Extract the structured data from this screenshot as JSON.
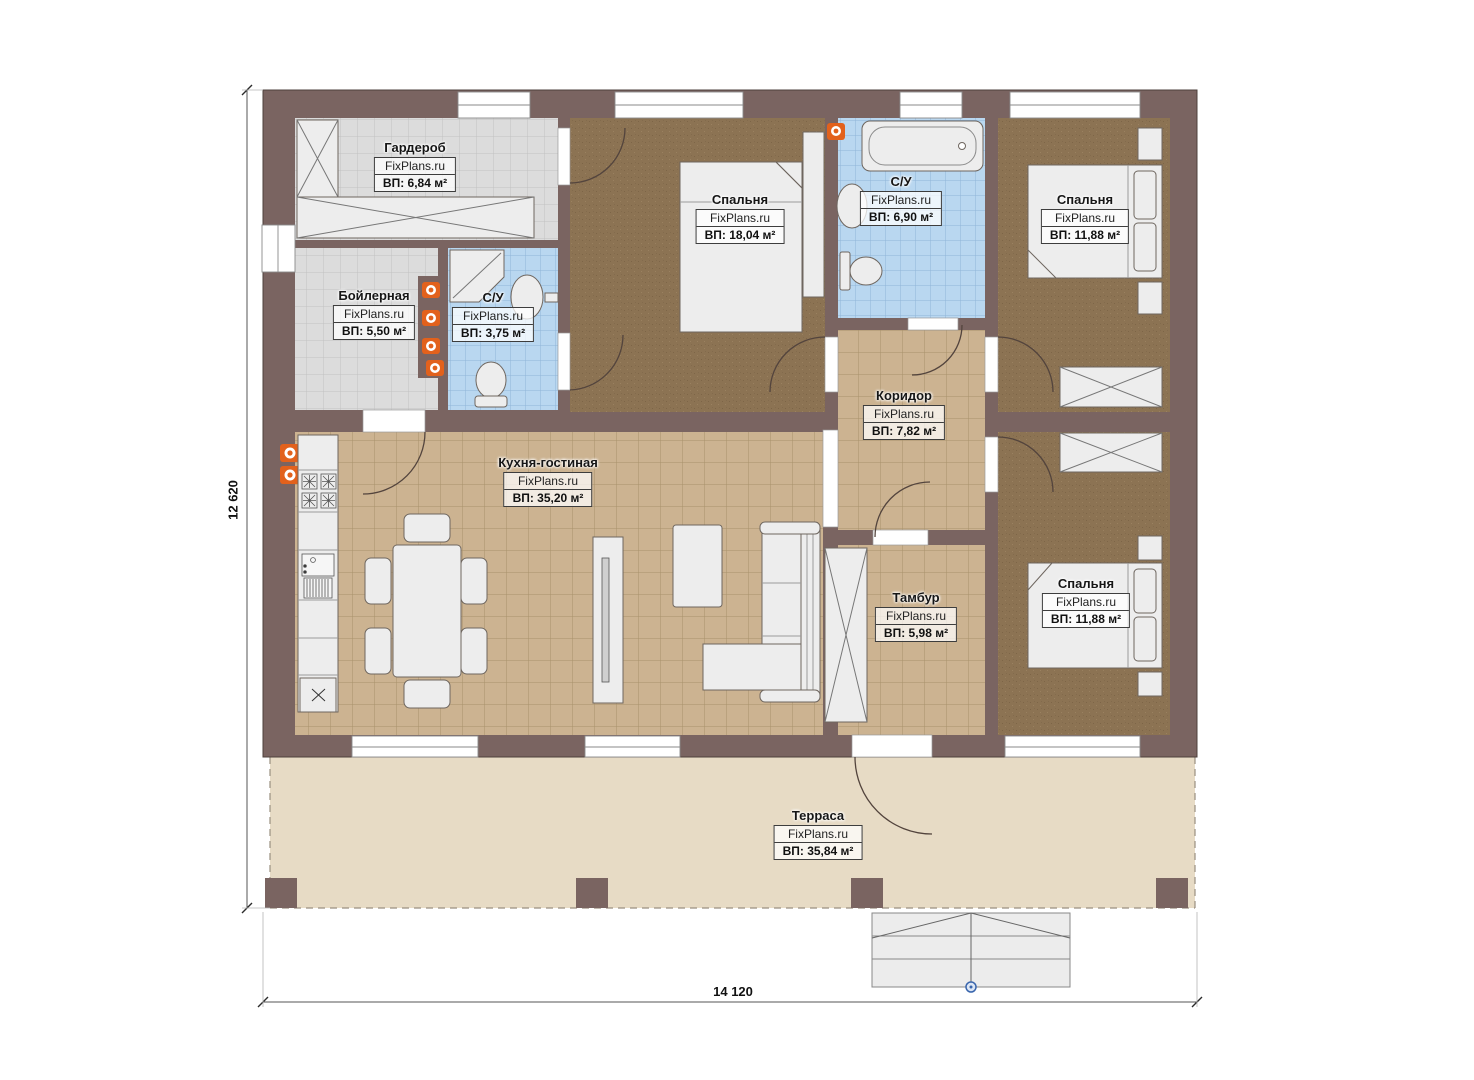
{
  "plan": {
    "brand": "FixPlans.ru",
    "rooms": [
      {
        "id": "wardrobe",
        "name": "Гардероб",
        "area_label": "ВП: 6,84 м²"
      },
      {
        "id": "boiler",
        "name": "Бойлерная",
        "area_label": "ВП: 5,50 м²"
      },
      {
        "id": "bath-small",
        "name": "С/У",
        "area_label": "ВП: 3,75 м²"
      },
      {
        "id": "bedroom-1",
        "name": "Спальня",
        "area_label": "ВП: 18,04 м²"
      },
      {
        "id": "bath-main",
        "name": "С/У",
        "area_label": "ВП: 6,90 м²"
      },
      {
        "id": "bedroom-2",
        "name": "Спальня",
        "area_label": "ВП: 11,88 м²"
      },
      {
        "id": "corridor",
        "name": "Коридор",
        "area_label": "ВП: 7,82 м²"
      },
      {
        "id": "kitchen-living",
        "name": "Кухня-гостиная",
        "area_label": "ВП: 35,20 м²"
      },
      {
        "id": "vestibule",
        "name": "Тамбур",
        "area_label": "ВП: 5,98 м²"
      },
      {
        "id": "bedroom-3",
        "name": "Спальня",
        "area_label": "ВП: 11,88 м²"
      },
      {
        "id": "terrace",
        "name": "Терраса",
        "area_label": "ВП: 35,84 м²"
      }
    ],
    "dimensions": {
      "height_label": "12 620",
      "width_label": "14 120"
    },
    "colors": {
      "wall": "#7a6461",
      "carpet": "#8c7353",
      "tile-tan": "#ccb391",
      "tile-blue": "#b9d7f0",
      "tile-gray": "#dcdcdc",
      "terrace": "#e7dbc5",
      "radiator": "#e2611c",
      "furniture": "#ededed"
    }
  }
}
